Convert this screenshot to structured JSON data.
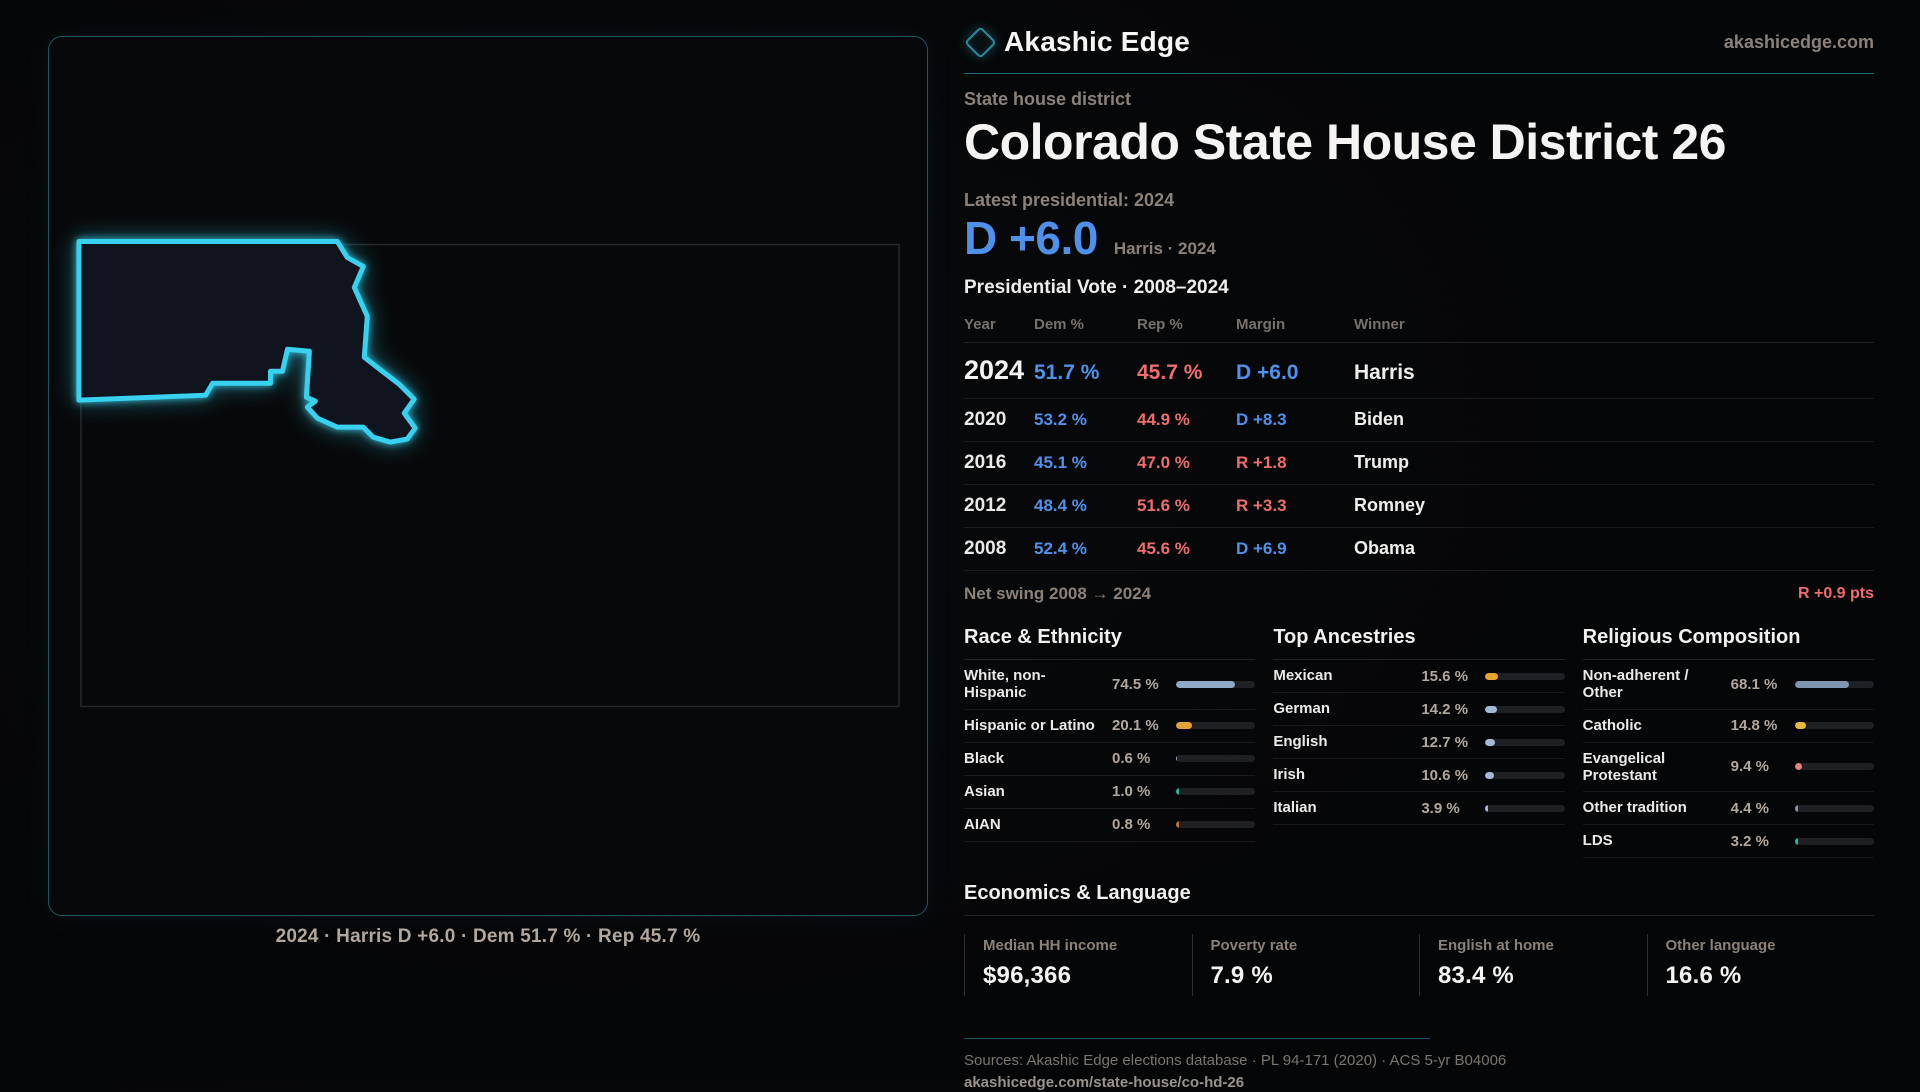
{
  "brand": {
    "name": "Akashic Edge",
    "site": "akashicedge.com"
  },
  "page": {
    "kicker": "State house district",
    "title": "Colorado State House District 26",
    "latest_label": "Latest presidential: 2024",
    "latest_margin": "D +6.0",
    "latest_sub": "Harris · 2024",
    "table_title": "Presidential Vote · 2008–2024"
  },
  "map": {
    "caption": "2024 · Harris D +6.0 · Dem 51.7 % · Rep 45.7 %",
    "outline_color": "#38d2f0"
  },
  "vote_table": {
    "headers": [
      "Year",
      "Dem %",
      "Rep %",
      "Margin",
      "Winner"
    ],
    "rows": [
      {
        "year": "2024",
        "dem": "51.7 %",
        "rep": "45.7 %",
        "margin": "D +6.0",
        "margin_party": "D",
        "winner": "Harris",
        "emphasis": true
      },
      {
        "year": "2020",
        "dem": "53.2 %",
        "rep": "44.9 %",
        "margin": "D +8.3",
        "margin_party": "D",
        "winner": "Biden",
        "emphasis": false
      },
      {
        "year": "2016",
        "dem": "45.1 %",
        "rep": "47.0 %",
        "margin": "R +1.8",
        "margin_party": "R",
        "winner": "Trump",
        "emphasis": false
      },
      {
        "year": "2012",
        "dem": "48.4 %",
        "rep": "51.6 %",
        "margin": "R +3.3",
        "margin_party": "R",
        "winner": "Romney",
        "emphasis": false
      },
      {
        "year": "2008",
        "dem": "52.4 %",
        "rep": "45.6 %",
        "margin": "D +6.9",
        "margin_party": "D",
        "winner": "Obama",
        "emphasis": false
      }
    ],
    "net_swing_label": "Net swing 2008 → 2024",
    "net_swing_value": "R +0.9 pts"
  },
  "demographics": {
    "race": {
      "title": "Race & Ethnicity",
      "rows": [
        {
          "label": "White, non-Hispanic",
          "value": "74.5 %",
          "pct": 74.5,
          "color": "#92a9c6"
        },
        {
          "label": "Hispanic or Latino",
          "value": "20.1 %",
          "pct": 20.1,
          "color": "#e2a33a"
        },
        {
          "label": "Black",
          "value": "0.6 %",
          "pct": 0.6,
          "color": "#9ab0c9"
        },
        {
          "label": "Asian",
          "value": "1.0 %",
          "pct": 1.0,
          "color": "#2fae97"
        },
        {
          "label": "AIAN",
          "value": "0.8 %",
          "pct": 0.8,
          "color": "#bf6e30"
        }
      ]
    },
    "ancestries": {
      "title": "Top Ancestries",
      "rows": [
        {
          "label": "Mexican",
          "value": "15.6 %",
          "pct": 15.6,
          "color": "#e8a42c"
        },
        {
          "label": "German",
          "value": "14.2 %",
          "pct": 14.2,
          "color": "#a4bad4"
        },
        {
          "label": "English",
          "value": "12.7 %",
          "pct": 12.7,
          "color": "#a4bad4"
        },
        {
          "label": "Irish",
          "value": "10.6 %",
          "pct": 10.6,
          "color": "#a4bad4"
        },
        {
          "label": "Italian",
          "value": "3.9 %",
          "pct": 3.9,
          "color": "#a4bad4"
        }
      ]
    },
    "religion": {
      "title": "Religious Composition",
      "rows": [
        {
          "label": "Non-adherent / Other",
          "value": "68.1 %",
          "pct": 68.1,
          "color": "#8095b0"
        },
        {
          "label": "Catholic",
          "value": "14.8 %",
          "pct": 14.8,
          "color": "#e7bb3e"
        },
        {
          "label": "Evangelical Protestant",
          "value": "9.4 %",
          "pct": 9.4,
          "color": "#e8827e"
        },
        {
          "label": "Other tradition",
          "value": "4.4 %",
          "pct": 4.4,
          "color": "#8395ab"
        },
        {
          "label": "LDS",
          "value": "3.2 %",
          "pct": 3.2,
          "color": "#2eb8a4"
        }
      ]
    }
  },
  "economics": {
    "title": "Economics & Language",
    "stats": [
      {
        "label": "Median HH income",
        "value": "$96,366"
      },
      {
        "label": "Poverty rate",
        "value": "7.9 %"
      },
      {
        "label": "English at home",
        "value": "83.4 %"
      },
      {
        "label": "Other language",
        "value": "16.6 %"
      }
    ]
  },
  "footer": {
    "sources": "Sources: Akashic Edge elections database · PL 94-171 (2020) · ACS 5-yr B04006",
    "permalink": "akashicedge.com/state-house/co-hd-26"
  },
  "colors": {
    "dem_blue": "#5191ec",
    "rep_red": "#ee6d6d",
    "cyan_accent": "#38d2f0",
    "teal_rule": "#1d6b7c",
    "muted_label": "#8b8179",
    "muted_value": "#b2a79c"
  }
}
